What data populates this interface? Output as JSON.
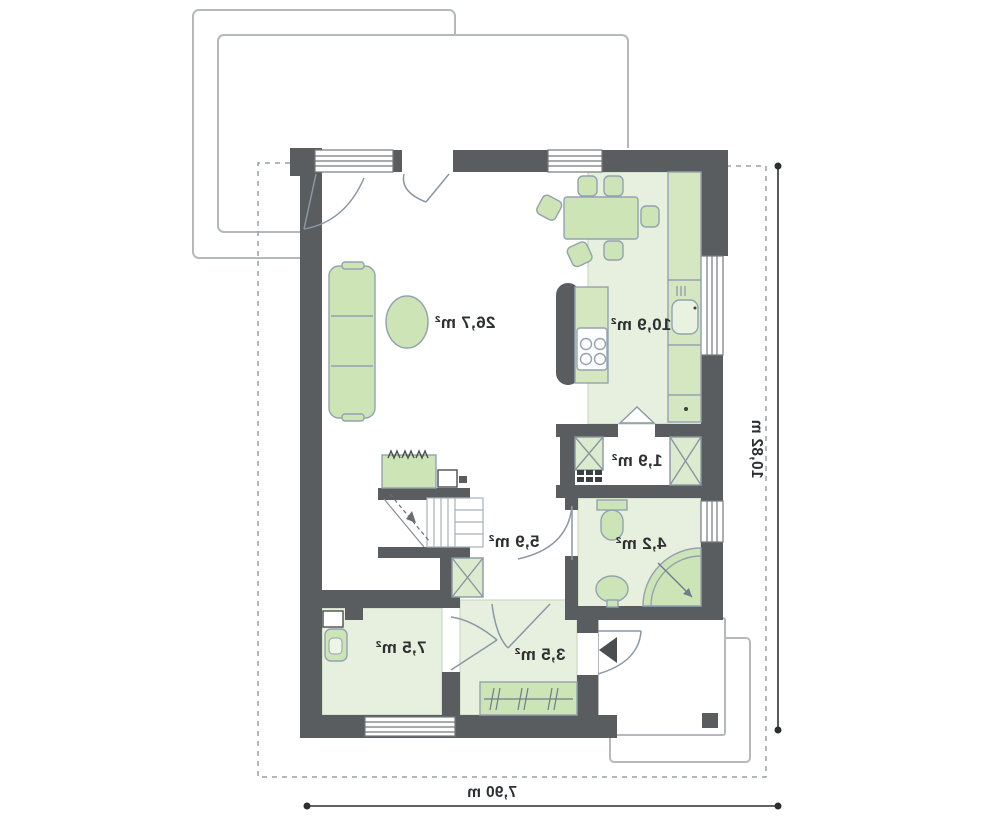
{
  "plan": {
    "rooms": [
      {
        "id": "living-dining",
        "area_label": "26,7 m²"
      },
      {
        "id": "kitchen",
        "area_label": "10,9 m²"
      },
      {
        "id": "pantry",
        "area_label": "1,9 m²"
      },
      {
        "id": "hall",
        "area_label": "5,9 m²"
      },
      {
        "id": "bathroom",
        "area_label": "4,2 m²"
      },
      {
        "id": "utility",
        "area_label": "7,5 m²"
      },
      {
        "id": "entry",
        "area_label": "3,5 m²"
      }
    ],
    "dimensions": {
      "height_label": "10,82 m",
      "width_label": "7,90 m"
    },
    "colors": {
      "wall": "#595d5f",
      "floor_green": "#e7f0de",
      "furniture_fill": "#cde4b6",
      "furniture_stroke": "#93a2b0",
      "outline_gray": "#b5b9bc",
      "dimension": "#2d3032"
    },
    "notes": {
      "text_style": "mirrored"
    }
  }
}
